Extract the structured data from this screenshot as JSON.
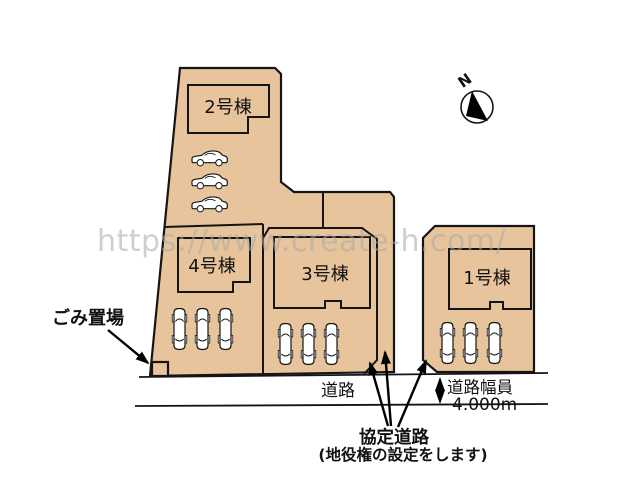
{
  "plan": {
    "watermark": "https://www.create-h.com/",
    "compass_label": "N",
    "buildings": [
      {
        "label": "2号棟"
      },
      {
        "label": "4号棟"
      },
      {
        "label": "3号棟"
      },
      {
        "label": "1号棟"
      }
    ],
    "car_counts": {
      "lot_2_area": 3,
      "lot_4_area": 3,
      "lot_3_area": 3,
      "lot_1_area": 3
    },
    "annotations": {
      "garbage": "ごみ置場",
      "road": "道路",
      "road_width_label": "道路幅員",
      "road_width_value": "4.000m",
      "agreement_road": "協定道路",
      "agreement_road_note": "(地役権の設定をします)"
    },
    "colors": {
      "lot_fill": "#e8c49c",
      "line": "#151515",
      "watermark": "#a9a9a9",
      "background": "#ffffff"
    }
  }
}
